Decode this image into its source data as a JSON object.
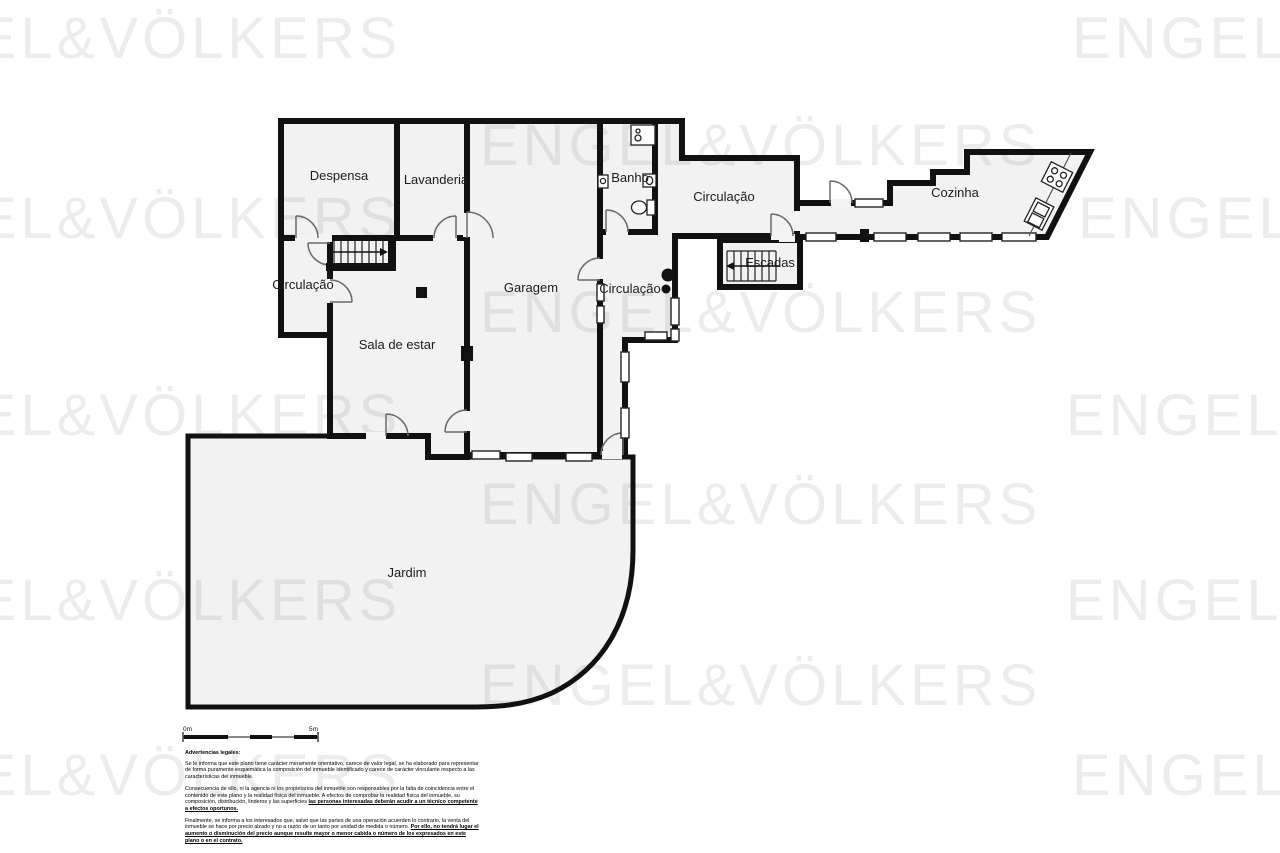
{
  "brand_watermark": {
    "text": "ENGEL&VÖLKERS",
    "color": "#ececec",
    "positions": [
      {
        "x": -160,
        "y": 5
      },
      {
        "x": 1072,
        "y": 5
      },
      {
        "x": 480,
        "y": 112
      },
      {
        "x": -160,
        "y": 185
      },
      {
        "x": 1078,
        "y": 185
      },
      {
        "x": 480,
        "y": 279
      },
      {
        "x": -160,
        "y": 382
      },
      {
        "x": 1066,
        "y": 382
      },
      {
        "x": 480,
        "y": 471
      },
      {
        "x": -160,
        "y": 567
      },
      {
        "x": 1066,
        "y": 567
      },
      {
        "x": 480,
        "y": 652
      },
      {
        "x": -160,
        "y": 742
      },
      {
        "x": 1072,
        "y": 742
      }
    ]
  },
  "floorplan": {
    "wall_color": "#111111",
    "room_fill": "#f1f1f1",
    "rooms": [
      {
        "id": "despensa",
        "label": "Despensa"
      },
      {
        "id": "lavanderia",
        "label": "Lavanderia"
      },
      {
        "id": "banho",
        "label": "Banho"
      },
      {
        "id": "circulacao-top",
        "label": "Circulação"
      },
      {
        "id": "cozinha",
        "label": "Cozinha"
      },
      {
        "id": "escadas",
        "label": "Escadas"
      },
      {
        "id": "garagem",
        "label": "Garagem"
      },
      {
        "id": "circulacao-mid",
        "label": "Circulação"
      },
      {
        "id": "circulacao-left",
        "label": "Circulação"
      },
      {
        "id": "sala-de-estar",
        "label": "Sala de estar"
      },
      {
        "id": "jardim",
        "label": "Jardim"
      }
    ]
  },
  "scalebar": {
    "start_label": "0m",
    "end_label": "5m"
  },
  "legal": {
    "title": "Advertencias legales:",
    "p1": "Se le informa que este plano tiene carácter meramente orientativo, carece de valor legal, se ha elaborado para representar de forma puramente esquemática la composición del inmueble identificado y carece de carácter vinculante respecto a las características del inmueble.",
    "p2": "Consecuencia de ello, ni la agencia ni los propietarios del inmueble son responsables por la falta de coincidencia entre el contenido de este plano y la realidad física del inmueble. A efectos de comprobar la realidad física del inmueble, su composición, distribución, linderos y las superficies ",
    "p2_underline": "las personas interesadas deberán acudir a un técnico competente a efectos oportunos.",
    "p3": "Finalmente, se informa a los interesados que, salvo que las partes de una operación acuerden lo contrario, la venta del inmueble se hace por precio alzado y no a razón de un tanto por unidad de medida o número. ",
    "p3_underline": "Por ello, no tendrá lugar el aumento o disminución del precio aunque resulte mayor o menor cabida o número de los expresados en este plano o en el contrato."
  }
}
